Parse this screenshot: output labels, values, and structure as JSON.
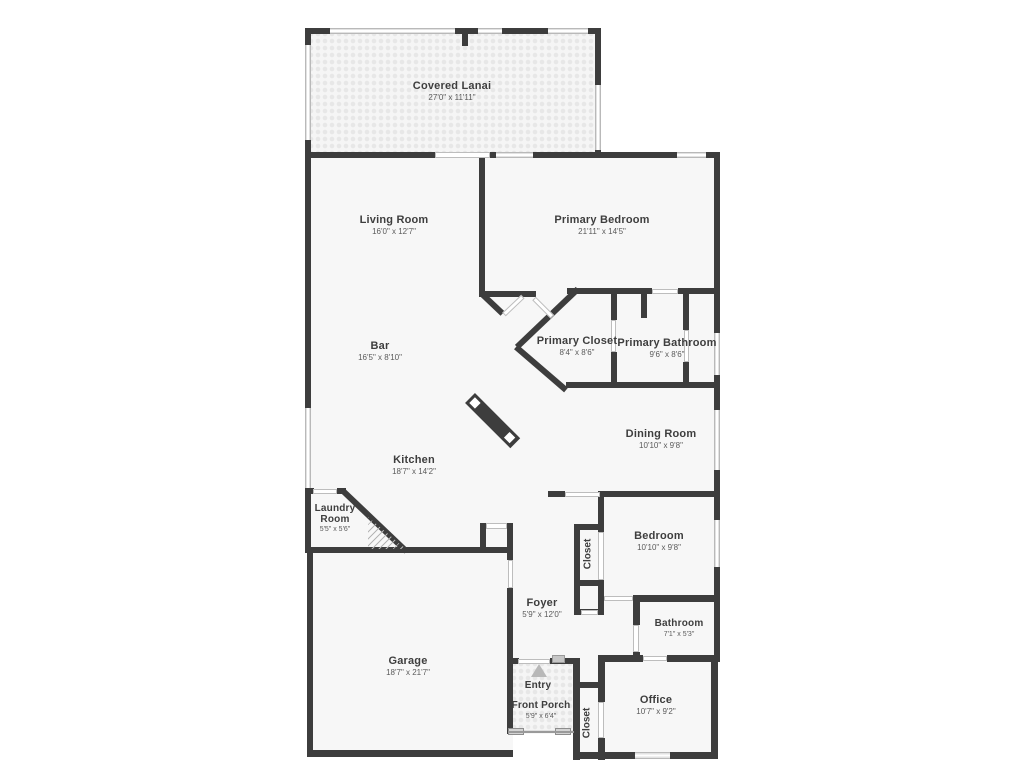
{
  "plan": {
    "wall_color": "#3d3d3d",
    "room_fill": "#f7f7f7",
    "window_color": "#e2e2e2",
    "entry_arrow_color": "#b8b8b8"
  },
  "rooms": {
    "covered_lanai": {
      "name": "Covered Lanai",
      "dims": "27'0\" x 11'11\""
    },
    "living_room": {
      "name": "Living Room",
      "dims": "16'0\" x 12'7\""
    },
    "primary_bedroom": {
      "name": "Primary Bedroom",
      "dims": "21'11\" x 14'5\""
    },
    "bar": {
      "name": "Bar",
      "dims": "16'5\" x 8'10\""
    },
    "primary_closet": {
      "name": "Primary Closet",
      "dims": "8'4\" x 8'6\""
    },
    "primary_bathroom": {
      "name": "Primary Bathroom",
      "dims": "9'6\" x 8'6\""
    },
    "dining_room": {
      "name": "Dining Room",
      "dims": "10'10\" x 9'8\""
    },
    "kitchen": {
      "name": "Kitchen",
      "dims": "18'7\" x 14'2\""
    },
    "laundry_room": {
      "name": "Laundry Room",
      "dims": "5'5\" x 5'6\""
    },
    "bedroom": {
      "name": "Bedroom",
      "dims": "10'10\" x 9'8\""
    },
    "bedroom_closet": {
      "name": "Closet"
    },
    "foyer": {
      "name": "Foyer",
      "dims": "5'9\" x 12'0\""
    },
    "bathroom": {
      "name": "Bathroom",
      "dims": "7'1\" x 5'3\""
    },
    "garage": {
      "name": "Garage",
      "dims": "18'7\" x 21'7\""
    },
    "entry": {
      "name": "Entry"
    },
    "front_porch": {
      "name": "Front Porch",
      "dims": "5'9\" x 6'4\""
    },
    "office_closet": {
      "name": "Closet"
    },
    "office": {
      "name": "Office",
      "dims": "10'7\" x 9'2\""
    }
  }
}
